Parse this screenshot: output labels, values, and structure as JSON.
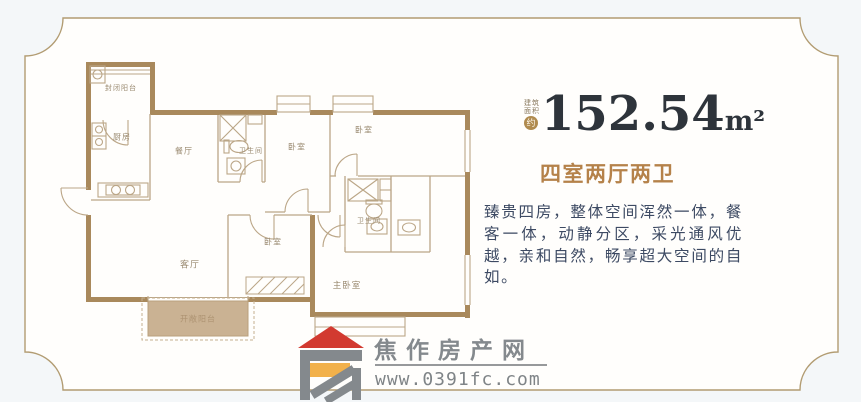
{
  "header": {
    "area_label_top": "建筑",
    "area_label_bottom": "面积",
    "area_prefix": "约",
    "area_value": "152.54",
    "area_unit": "m²",
    "layout_title": "四室两厅两卫"
  },
  "description": {
    "text": "臻贵四房，整体空间浑然一体，餐客一体，动静分区，采光通风优越，亲和自然，畅享超大空间的自如。"
  },
  "floorplan": {
    "rooms": [
      {
        "label": "封闭阳台",
        "x": 121,
        "y": 88,
        "fs": 7
      },
      {
        "label": "厨房",
        "x": 122,
        "y": 137,
        "fs": 8
      },
      {
        "label": "餐厅",
        "x": 184,
        "y": 151,
        "fs": 8
      },
      {
        "label": "卫生间",
        "x": 251,
        "y": 151,
        "fs": 7
      },
      {
        "label": "卧室",
        "x": 297,
        "y": 147,
        "fs": 8
      },
      {
        "label": "卧室",
        "x": 364,
        "y": 130,
        "fs": 8
      },
      {
        "label": "卫生间",
        "x": 369,
        "y": 221,
        "fs": 7
      },
      {
        "label": "卧室",
        "x": 273,
        "y": 242,
        "fs": 8
      },
      {
        "label": "客厅",
        "x": 190,
        "y": 264,
        "fs": 9
      },
      {
        "label": "主卧室",
        "x": 347,
        "y": 285,
        "fs": 8.5
      },
      {
        "label": "开敞阳台",
        "x": 198,
        "y": 319,
        "fs": 8,
        "muted": true
      }
    ]
  },
  "logo": {
    "site_name": "焦作房产网",
    "site_url": "www.0391fc.com"
  },
  "colors": {
    "frame_border": "#b29c72",
    "paper": "#fffefc",
    "wall": "#a9895c",
    "plan_line": "#bba687",
    "room_label": "#99896f",
    "balcony_fill": "#cab293",
    "accent_title": "#b5824a",
    "area_number": "#2e343b",
    "description_text": "#3d4a63",
    "logo_gray": "#84898d",
    "logo_red": "#d23a30",
    "logo_orange": "#f2b14b"
  }
}
